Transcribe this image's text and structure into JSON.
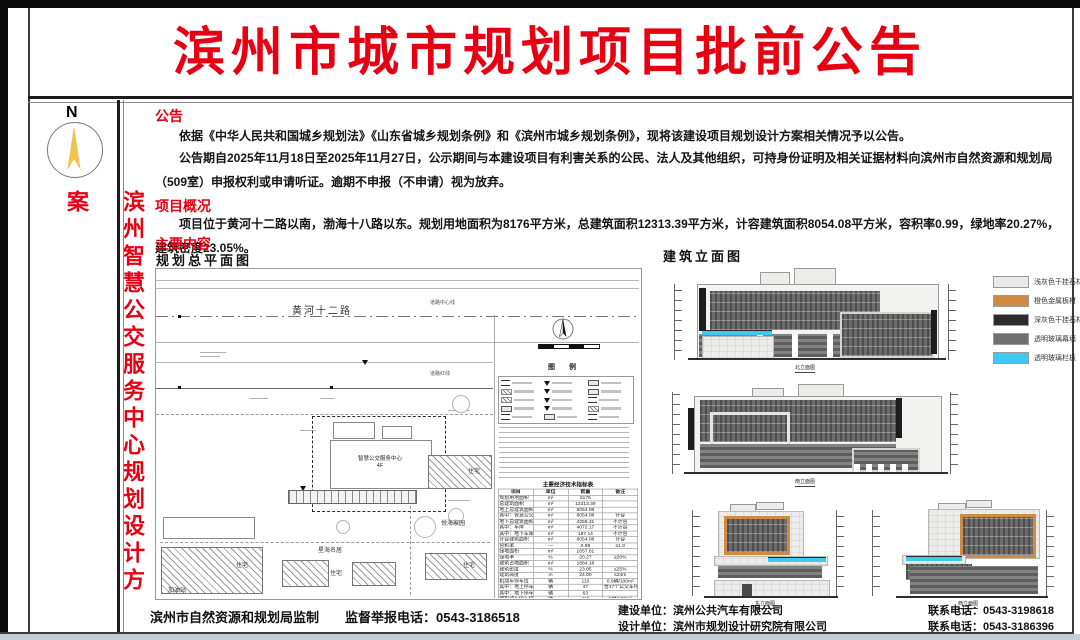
{
  "title": "滨州市城市规划项目批前公告",
  "sidebar": {
    "compass_n": "N",
    "project_name": "滨州智慧公交服务中心规划设计方案"
  },
  "announcement": {
    "heading": "公告",
    "para1": "依据《中华人民共和国城乡规划法》《山东省城乡规划条例》和《滨州市城乡规划条例》，现将该建设项目规划设计方案相关情况予以公告。",
    "para2": "公告期自2025年11月18日至2025年11月27日，公示期间与本建设项目有利害关系的公民、法人及其他组织，可持身份证明及相关证据材料向滨州市自然资源和规划局（509室）申报权利或申请听证。逾期不申报（不申请）视为放弃。"
  },
  "overview": {
    "heading": "项目概况",
    "para": "项目位于黄河十二路以南，渤海十八路以东。规划用地面积为8176平方米，总建筑面积12313.39平方米，计容建筑面积8054.08平方米，容积率0.99，绿地率20.27%，建筑密度23.05%。"
  },
  "main_content": {
    "heading": "主要内容"
  },
  "site_plan": {
    "heading": "规划总平面图",
    "road_label": "黄河十二路",
    "centerline_label": "道路中心线",
    "redline_label": "道路红线",
    "building_label": "智慧公交服务中心",
    "building_floors": "4F",
    "residential_label": "住宅",
    "community_right": "悦海家园",
    "community_bottom": "星海名居",
    "gas_station": "加油站",
    "legend_title": "图 例",
    "table": {
      "title": "主要经济技术指标表",
      "headers": [
        "项目",
        "单位",
        "数量",
        "备注"
      ],
      "rows": [
        [
          "规划用地面积",
          "m²",
          "8176",
          ""
        ],
        [
          "总建筑面积",
          "m²",
          "12313.39",
          ""
        ],
        [
          "地上总建筑面积",
          "m²",
          "8054.08",
          ""
        ],
        [
          "其中：智慧公交服务中心",
          "m²",
          "8054.08",
          "计容"
        ],
        [
          "地下总建筑面积",
          "m²",
          "4259.31",
          "不计容"
        ],
        [
          "其中：车库",
          "m²",
          "4072.17",
          "不计容"
        ],
        [
          "其中：地下车库出入口",
          "m²",
          "187.14",
          "不计容"
        ],
        [
          "计容建筑面积",
          "m²",
          "8054.08",
          "计容"
        ],
        [
          "容积率",
          "—",
          "0.99",
          "≤1.0"
        ],
        [
          "绿地面积",
          "m²",
          "1657.61",
          ""
        ],
        [
          "绿地率",
          "%",
          "20.27",
          "≥20%"
        ],
        [
          "建筑占地面积",
          "m²",
          "1884.18",
          ""
        ],
        [
          "建筑密度",
          "%",
          "23.05",
          "≤25%"
        ],
        [
          "建筑高度",
          "m",
          "24.00",
          "≤24m"
        ],
        [
          "机动车停车位",
          "辆",
          "110",
          "0.9辆/100m²"
        ],
        [
          "其中：地上停车位",
          "辆",
          "47",
          "含47个公交车停车位"
        ],
        [
          "其中：地下停车位",
          "辆",
          "63",
          ""
        ],
        [
          "非机动车停车位",
          "辆",
          "418",
          "5辆/100m²"
        ]
      ]
    }
  },
  "elevations": {
    "heading": "建筑立面图",
    "labels": {
      "north": "北立面图",
      "south": "南立面图",
      "east": "东立面图",
      "west": "西立面图"
    },
    "materials": [
      {
        "label": "浅灰色干挂石材",
        "color": "#e9e9e6"
      },
      {
        "label": "橙色金属板材",
        "color": "#d28a3e"
      },
      {
        "label": "深灰色干挂石材",
        "color": "#2b2b2b"
      },
      {
        "label": "透明玻璃幕墙",
        "color": "#6f6f6f"
      },
      {
        "label": "透明玻璃栏板",
        "color": "#3cc9f2"
      }
    ]
  },
  "footer": {
    "supervisor": "滨州市自然资源和规划局监制",
    "hotline": "监督举报电话：0543-3186518",
    "builder": "建设单位：滨州公共汽车有限公司",
    "designer": "设计单位：滨州市规划设计研究院有限公司",
    "builder_phone": "联系电话：0543-3198618",
    "designer_phone": "联系电话：0543-3186396"
  },
  "colors": {
    "accent_red": "#e60012",
    "orange_metal": "#cd8b44",
    "glass_cyan": "#3cc9f2"
  }
}
